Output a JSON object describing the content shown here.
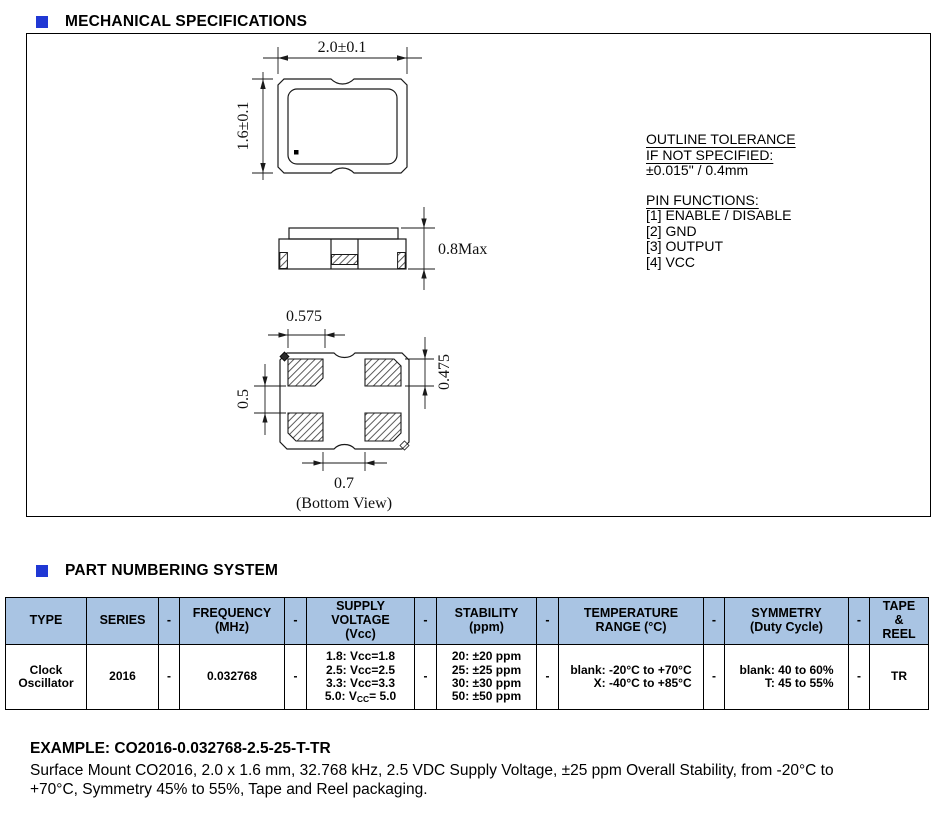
{
  "colors": {
    "accent_blue": "#2038d4",
    "table_header_bg": "#a9c4e3",
    "line_color": "#1a1a1a"
  },
  "sections": {
    "mechanical": {
      "title": "MECHANICAL SPECIFICATIONS"
    },
    "part_numbering": {
      "title": "PART NUMBERING SYSTEM"
    }
  },
  "drawing": {
    "top_view": {
      "width_dim": "2.0±0.1",
      "height_dim": "1.6±0.1"
    },
    "side_view": {
      "height_dim": "0.8Max"
    },
    "bottom_view": {
      "pad_width_dim": "0.575",
      "pad_height_dim": "0.475",
      "pad_gap_v_dim": "0.5",
      "pad_gap_h_dim": "0.7",
      "caption": "(Bottom View)"
    },
    "notes": {
      "outline_tolerance_title": "OUTLINE TOLERANCE",
      "outline_tolerance_subtitle": "IF NOT SPECIFIED:",
      "outline_tolerance_value": "±0.015\" / 0.4mm",
      "pin_functions_title": "PIN FUNCTIONS:",
      "pin_functions": [
        "[1] ENABLE / DISABLE",
        "[2] GND",
        "[3] OUTPUT",
        "[4] VCC"
      ]
    }
  },
  "table": {
    "headers": [
      "TYPE",
      "SERIES",
      "-",
      "FREQUENCY\n(MHz)",
      "-",
      "SUPPLY\nVOLTAGE\n(Vcc)",
      "-",
      "STABILITY\n(ppm)",
      "-",
      "TEMPERATURE\nRANGE (°C)",
      "-",
      "SYMMETRY\n(Duty Cycle)",
      "-",
      "TAPE\n&\nREEL"
    ],
    "row": [
      "Clock\nOscillator",
      "2016",
      "-",
      "0.032768",
      "-",
      "1.8: Vcc=1.8\n2.5: Vcc=2.5\n3.3: Vcc=3.3\n5.0: V~CC~= 5.0",
      "-",
      "20: ±20 ppm\n25: ±25 ppm\n30: ±30 ppm\n50: ±50 ppm",
      "-",
      "blank: -20°C to +70°C\nX: -40°C to +85°C",
      "-",
      "blank: 40 to 60%\nT: 45 to 55%",
      "-",
      "TR"
    ]
  },
  "example": {
    "title": "EXAMPLE: CO2016-0.032768-2.5-25-T-TR",
    "description": "Surface Mount CO2016, 2.0 x 1.6 mm, 32.768 kHz, 2.5 VDC Supply Voltage, ±25 ppm Overall Stability, from -20°C to\n+70°C, Symmetry 45% to 55%, Tape and Reel packaging."
  }
}
